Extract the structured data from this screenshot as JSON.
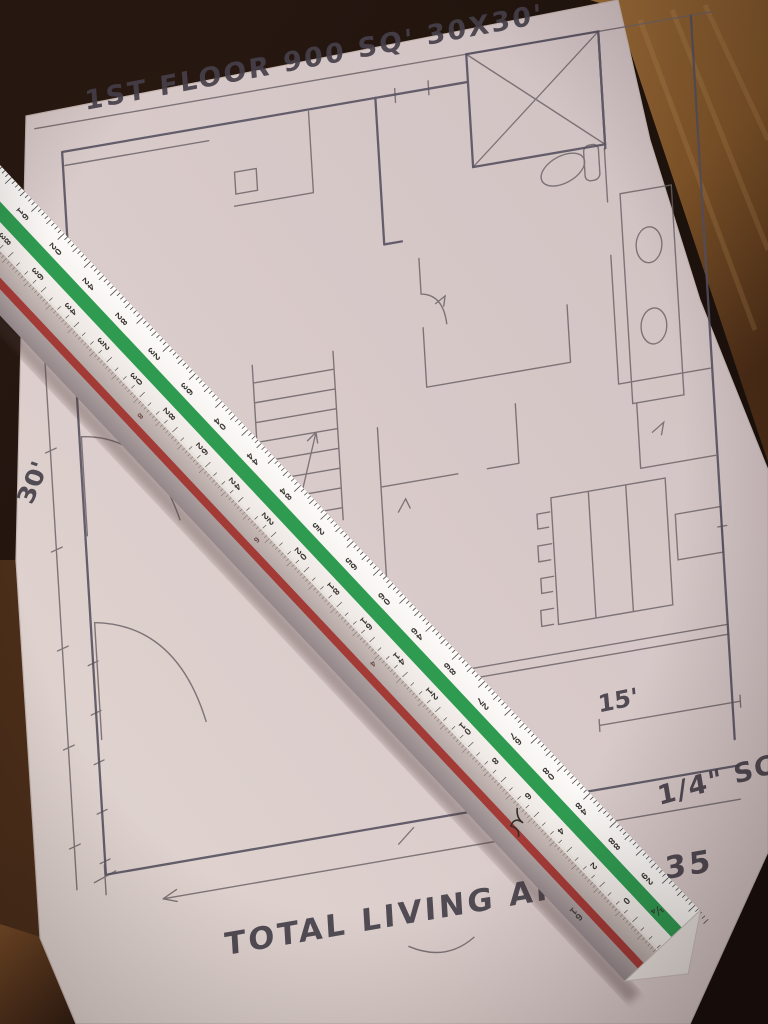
{
  "drawing": {
    "title": "1ST FLOOR  900 SQ'  30X30'",
    "total_area_note": "TOTAL LIVING AREA  1,35",
    "scale_note": "1/4\" SCA",
    "dim_left": "30'",
    "dim_bottom": "30",
    "dim_right": "15'"
  },
  "ruler": {
    "upper_scale_numbers": [
      12,
      16,
      20,
      24,
      28,
      32,
      36,
      40,
      44,
      48,
      52,
      56,
      60,
      64,
      68,
      72,
      76,
      80,
      84,
      88,
      92
    ],
    "lower_scale_numbers": [
      40,
      38,
      36,
      34,
      32,
      30,
      28,
      26,
      24,
      22,
      20,
      18,
      16,
      14,
      12,
      10,
      8,
      6,
      4,
      2,
      0
    ],
    "end_scale_label": "¼",
    "lower_face_numbers": [
      "8",
      "6",
      "4"
    ],
    "lower_face_end_label": "16",
    "green_stripe": "#2f9b51",
    "red_stripe": "#a23a36"
  },
  "colors": {
    "paper": "#d9cbc9",
    "pencil": "#6e6569",
    "ink": "#46404a",
    "wood_warm": "#93672f",
    "wood_dark": "#20140e",
    "ruler_white": "#f6f2ef"
  }
}
